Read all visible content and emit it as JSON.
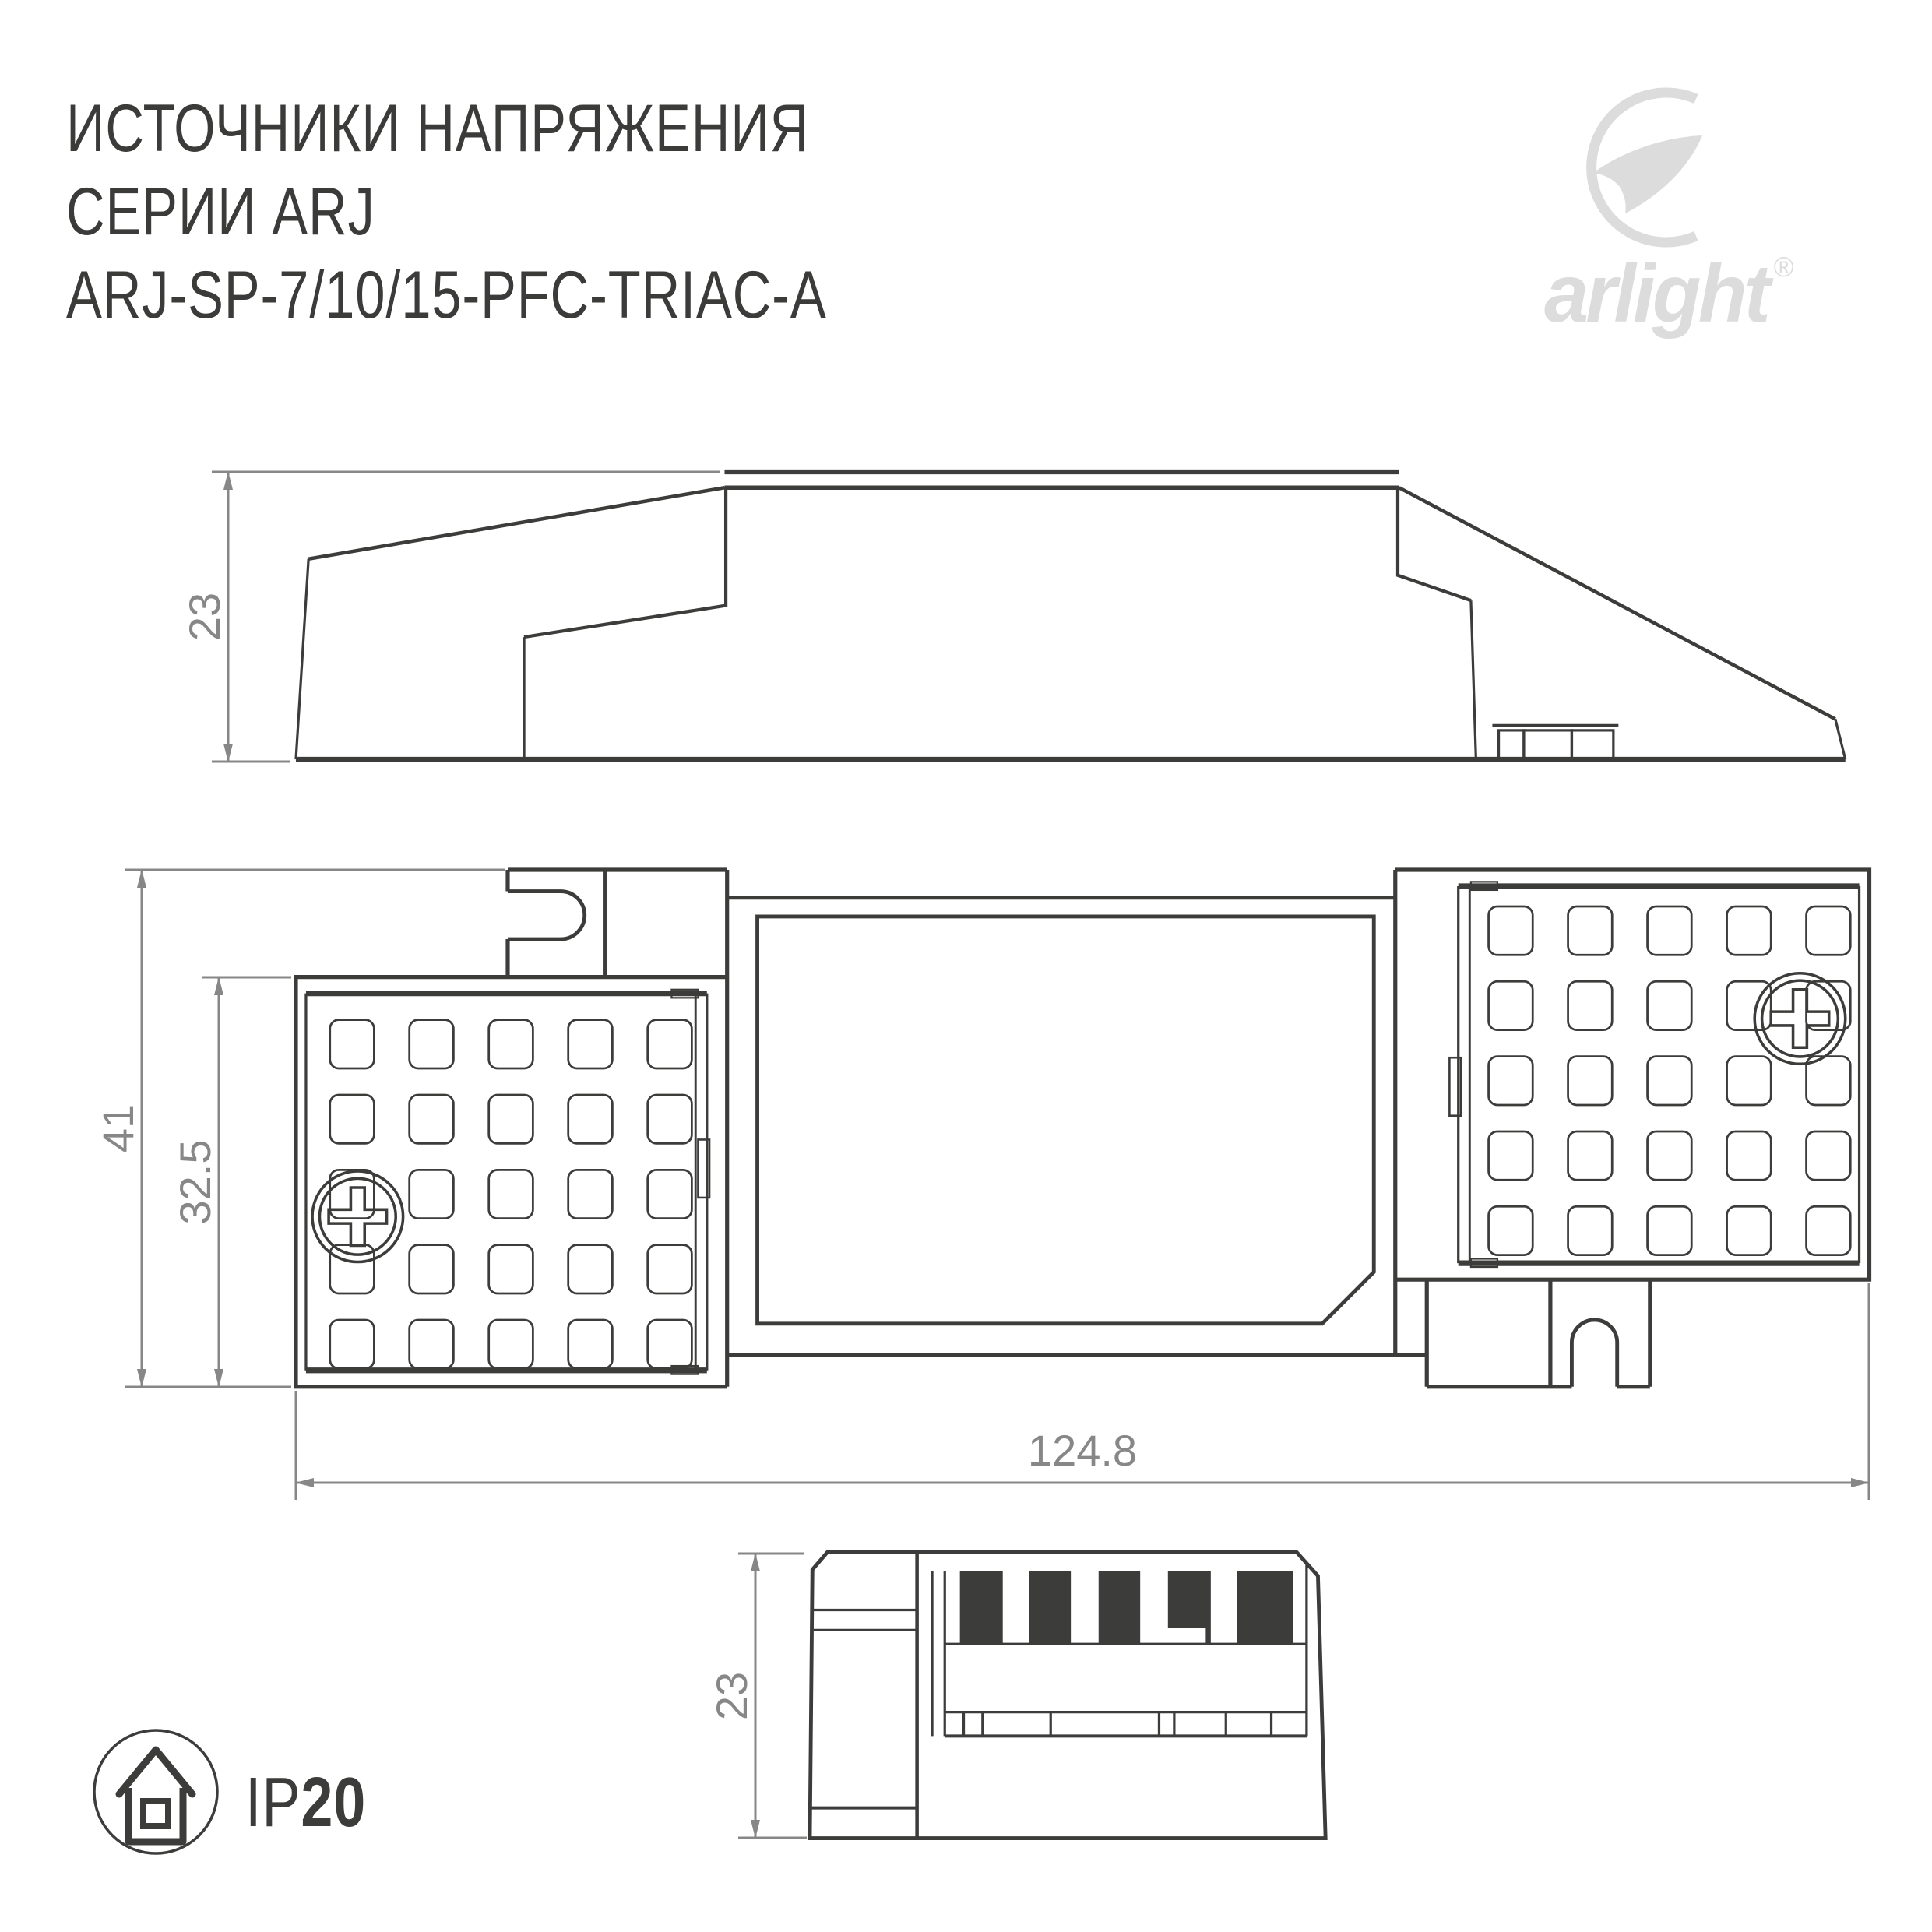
{
  "title": {
    "line1": "ИСТОЧНИКИ НАПРЯЖЕНИЯ",
    "line2": "СЕРИИ ARJ",
    "line3": "ARJ-SP-7/10/15-PFC-TRIAC-A"
  },
  "brand": {
    "name": "arlight",
    "registered": "®",
    "icon": "swoosh-icon"
  },
  "dimensions": {
    "side_height": "23",
    "top_overall_height": "41",
    "top_body_height": "32.5",
    "length": "124.8",
    "end_height": "23"
  },
  "protection": {
    "prefix": "IP",
    "value": "20",
    "icon": "house-in-circle-icon"
  },
  "colors": {
    "ink": "#3c3c3b",
    "dimension": "#878787",
    "logo": "#dcdcdd",
    "background": "#ffffff"
  }
}
